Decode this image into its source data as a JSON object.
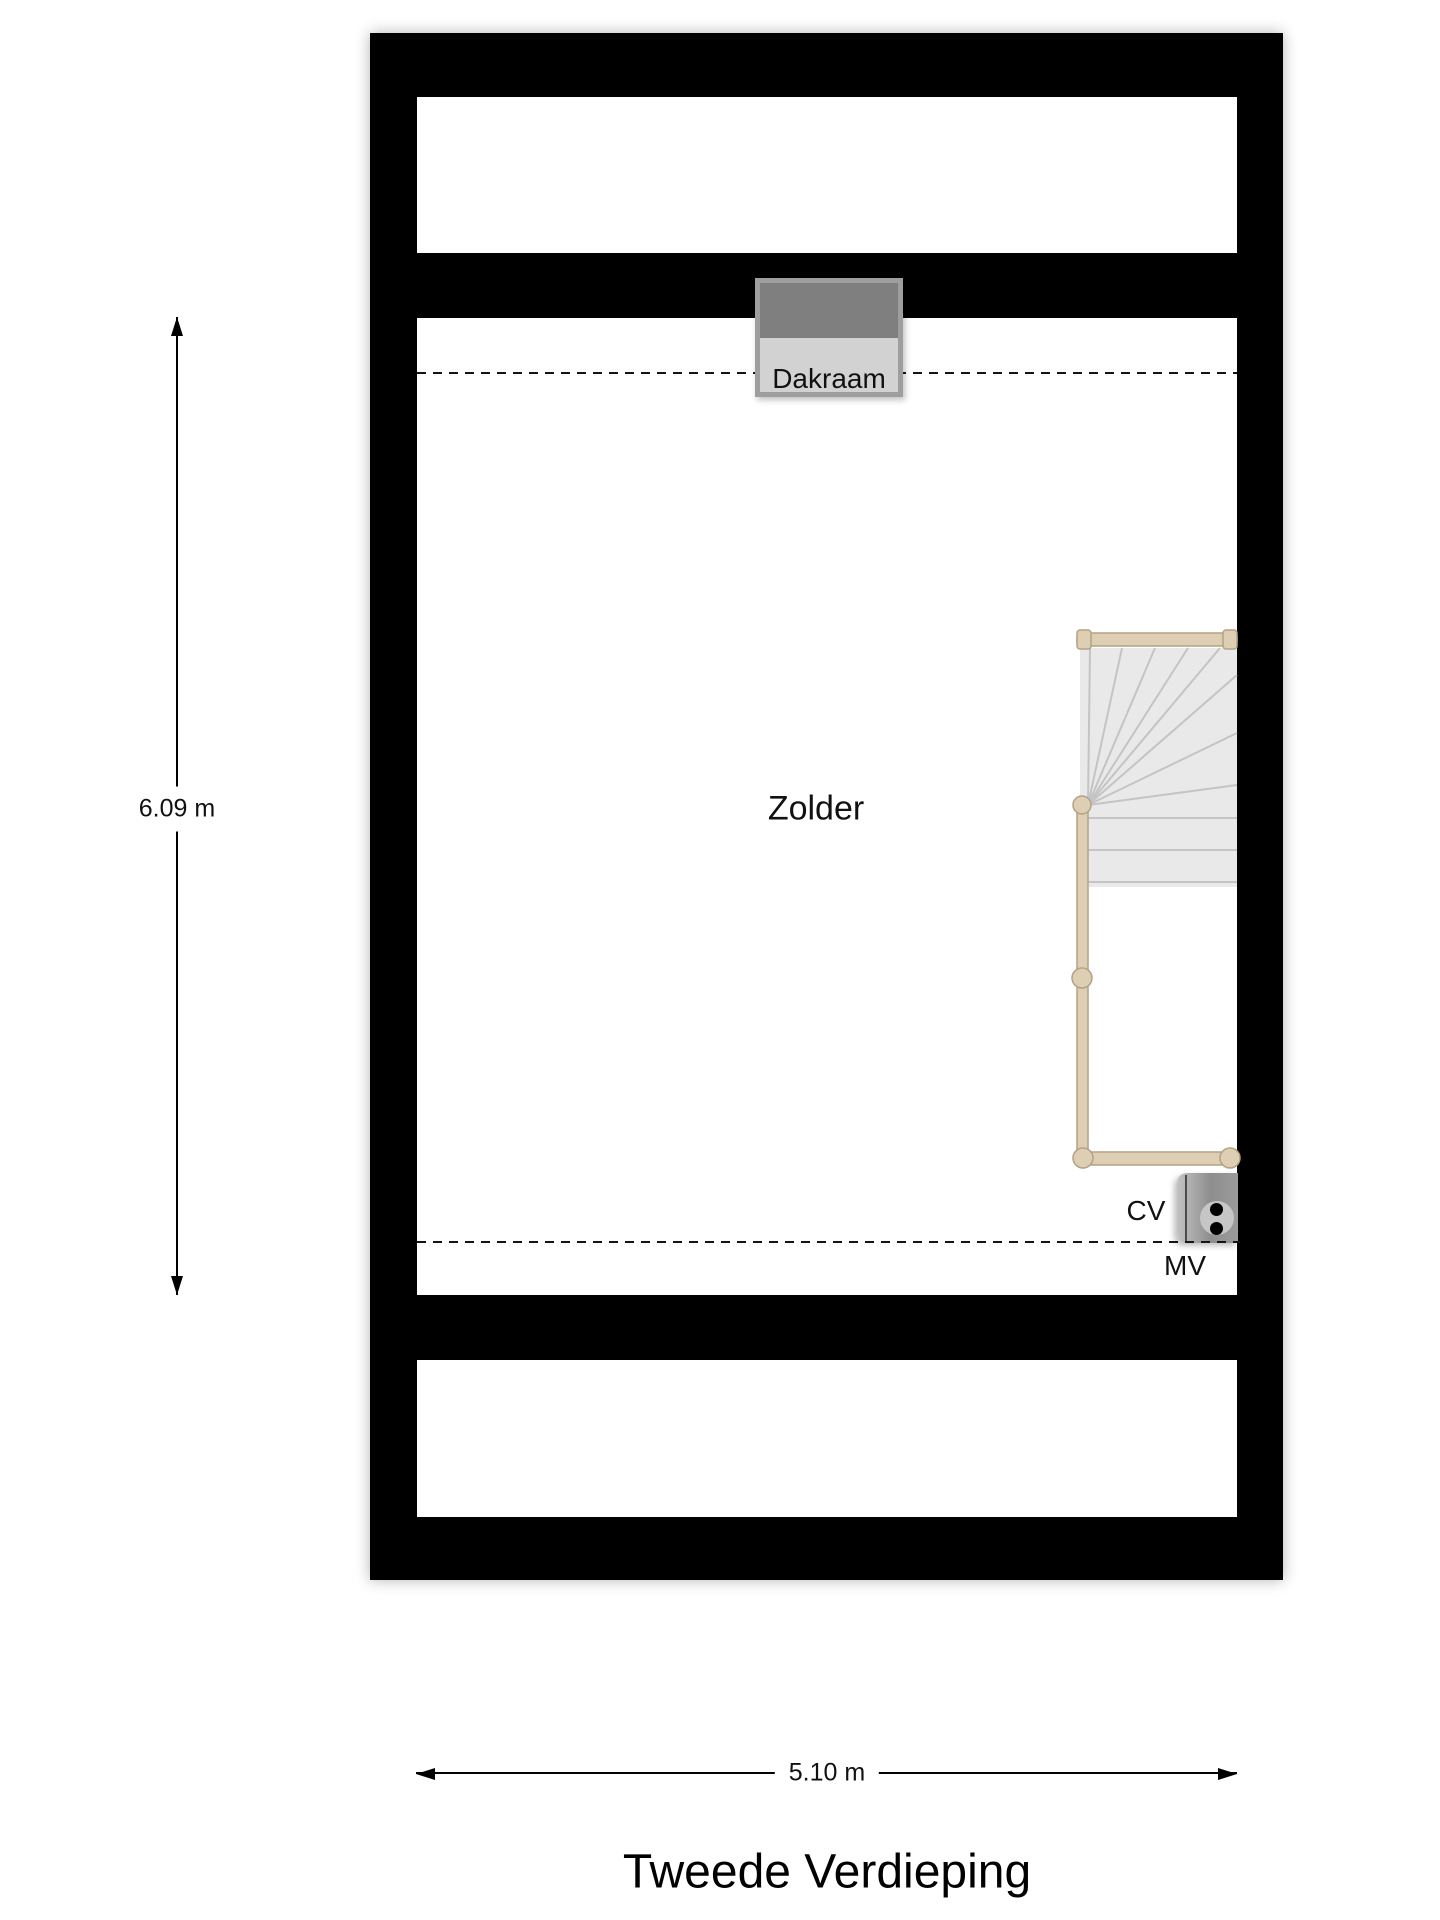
{
  "title": "Tweede Verdieping",
  "room": {
    "label": "Zolder"
  },
  "skylight": {
    "label": "Dakraam"
  },
  "appliances": {
    "cv_label": "CV",
    "mv_label": "MV"
  },
  "dimensions": {
    "vertical_label": "6.09 m",
    "horizontal_label": "5.10 m"
  },
  "colors": {
    "wall": "#000000",
    "floor": "#ffffff",
    "skylight_frame": "#9e9e9e",
    "skylight_fill": "#d2d2d2",
    "skylight_sash": "#7f7f7f",
    "stair_fill": "#e9e9e9",
    "stair_line": "#c4c4c4",
    "rail": "#ddceb4",
    "rail_border": "#b3a283",
    "cv_unit": "#9a9a9a"
  }
}
